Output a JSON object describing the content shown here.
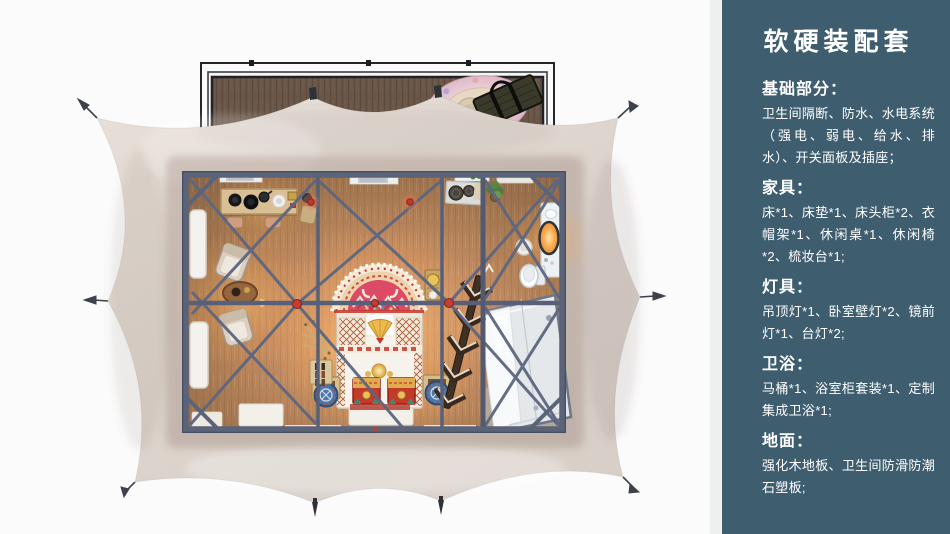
{
  "sidebar": {
    "title": "软硬装配套",
    "sections": [
      {
        "heading": "基础部分：",
        "body": "卫生间隔断、防水、水电系统（强电、弱电、给水、排水）、开关面板及插座；"
      },
      {
        "heading": "家具：",
        "body": "床*1、床垫*1、床头柜*2、衣帽架*1、休闲桌*1、休闲椅*2、梳妆台*1;"
      },
      {
        "heading": "灯具：",
        "body": "吊顶灯*1、卧室壁灯*2、镜前灯*1、台灯*2;"
      },
      {
        "heading": "卫浴：",
        "body": "马桶*1、浴室柜套装*1、定制集成卫浴*1;"
      },
      {
        "heading": "地面：",
        "body": "强化木地板、卫生间防滑防潮石塑板;"
      }
    ]
  },
  "colors": {
    "sidebar_bg": "#3E5D6F",
    "sidebar_divider": "#EDF0EE",
    "tent_canvas": "#DDD4CD",
    "deck_wood": "#6A5646",
    "floor_wood": "#C68E64",
    "steel_frame": "#5A6378",
    "connector_red": "#C43C32",
    "warm_glow": "#F5A348",
    "text": "#FFFFFF"
  },
  "floorplan": {
    "items": [
      "deck",
      "outdoor-rug",
      "woven-seat",
      "bench",
      "tent-canvas",
      "guy-line-peg",
      "ground-stake",
      "canvas-hook",
      "steel-frame",
      "cross-brace",
      "connector-node",
      "wood-floor",
      "window",
      "ceiling-vent",
      "console-desk",
      "desk-stool",
      "wall-lamp",
      "lounge-chair",
      "round-tea-table",
      "floor-lamp",
      "bed",
      "headboard-arch-rug",
      "folded-blanket-fan",
      "storage-chest",
      "tiered-stand",
      "bedside-crate",
      "drum-stool",
      "shoe-rack",
      "quilt-rack",
      "chevron-shelf",
      "side-table",
      "washstand",
      "plant",
      "vanity-counter",
      "vanity-mirror",
      "vanity-stool",
      "toilet",
      "shower-enclosure",
      "door-mat"
    ]
  }
}
